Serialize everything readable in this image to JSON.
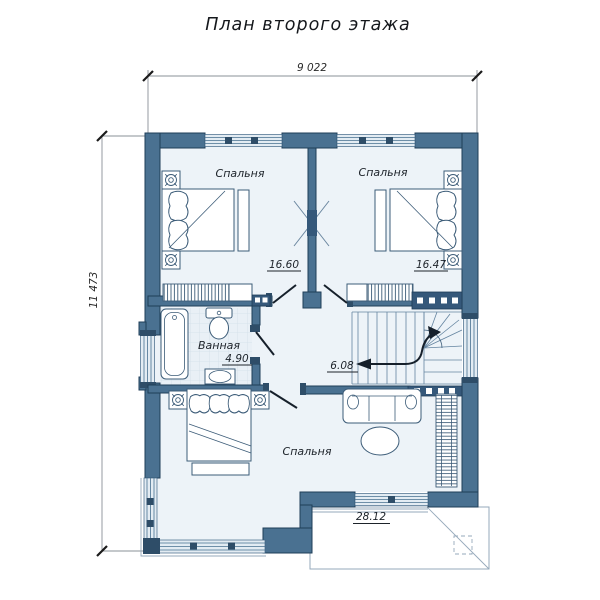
{
  "title": "План второго этажа",
  "dimensions": {
    "width_label": "9 022",
    "height_label": "11 473"
  },
  "rooms": {
    "bedroom_top_left": {
      "name": "Спальня",
      "area": "16.60"
    },
    "bedroom_top_right": {
      "name": "Спальня",
      "area": "16.47"
    },
    "bathroom": {
      "name": "Ванная",
      "area": "4.90"
    },
    "hall": {
      "area": "6.08"
    },
    "bedroom_bottom": {
      "name": "Спальня",
      "area": "28.12"
    }
  },
  "colors": {
    "wall": "#4a7191",
    "wall_outline": "#1f3e58",
    "wall_dark": "#35587a",
    "floor": "#edf3f8",
    "window": "#e3ecf3",
    "furniture_line": "#3c5c78",
    "text": "#1d232a",
    "dimension_line": "#8a9097"
  }
}
